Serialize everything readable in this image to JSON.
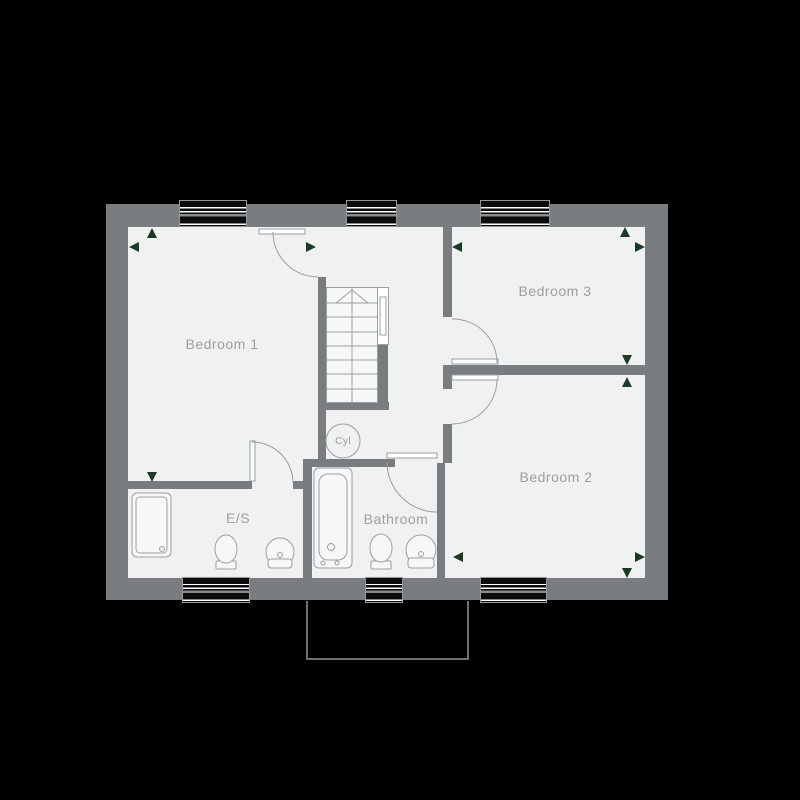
{
  "plan": {
    "rooms": {
      "bedroom1": {
        "label": "Bedroom 1"
      },
      "bedroom2": {
        "label": "Bedroom 2"
      },
      "bedroom3": {
        "label": "Bedroom 3"
      },
      "bathroom": {
        "label": "Bathroom"
      },
      "ensuite": {
        "label": "E/S"
      },
      "cylinder": {
        "label": "Cyl"
      }
    },
    "colors": {
      "background": "#000000",
      "wall": "#7a7d80",
      "room_fill": "#f0f1f1",
      "fixture_fill": "#f6f7f7",
      "line": "#9aa0a2",
      "label_text": "#9ba0a2",
      "window_glass": "#0c0c0c",
      "dimension_marker_green": "#1c3b27",
      "lower_roof_outline": "#6e7174"
    }
  }
}
